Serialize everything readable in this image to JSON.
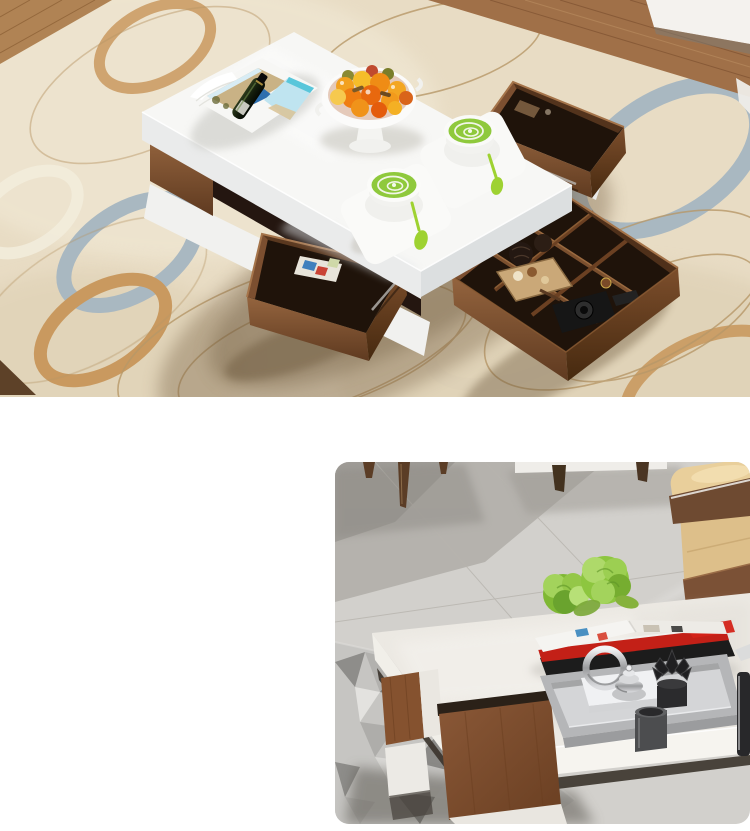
{
  "page": {
    "width": 750,
    "height": 831,
    "background": "#ffffff"
  },
  "photo_top": {
    "alt": "Overhead view of a white high-gloss coffee table with walnut pull-out drawers and an open storage organizer, styled with two matcha lattes, a white fruit bowl and an open magazine with a bottle, standing on a beige rug with blue and caramel ring pattern and wood flooring",
    "rect": {
      "x": 0,
      "y": 0,
      "width": 750,
      "height": 397
    },
    "palette": {
      "rug": "#e8dcc4",
      "ring_blue": "#a9b8c1",
      "ring_caramel": "#c9995f",
      "ring_gold_line": "#b79868",
      "wood_floor": "#a07048",
      "tv_cabinet_white": "#f4f2ee",
      "table_white": "#f7f7f5",
      "walnut": "#7c4f30",
      "drawer_interior": "#1f130a",
      "matcha": "#8fc93c",
      "spoon_green": "#9ed231",
      "fruit_orange": "#ef8c15",
      "magazine_sand": "#c9b285",
      "magazine_sky": "#bfe4f0",
      "car_blue": "#2e6fae",
      "bottle_green": "#1e2b14"
    },
    "objects": [
      "area-rug",
      "wood-floor",
      "tv-cabinet",
      "coffee-table",
      "tabletop",
      "open-magazine",
      "bottle",
      "fruit-bowl",
      "matcha-cup-front",
      "matcha-cup-back",
      "green-spoons",
      "open-drawer-upper",
      "open-drawer-lower",
      "storage-organizer",
      "camera",
      "wicker-balls",
      "snack-tray"
    ]
  },
  "photo_bottom": {
    "alt": "Close-up of a cream stone-look coffee table with walnut drawer fronts in a living room with grey marble floor, beige leather sofa, grey patchwork rug, magazines, green flowers and a silver decor tray with chrome and black ornaments",
    "rect": {
      "x": 335,
      "y": 462,
      "width": 415,
      "height": 362,
      "corner_radius": 14
    },
    "palette": {
      "marble_floor": "#d2d0cc",
      "floor_shadow": "#a8a5a0",
      "chair_leg": "#5b3d26",
      "sofa_beige": "#ddbf8a",
      "sofa_brown": "#6e4a31",
      "rug_grey": "#c6c5c2",
      "table_cream": "#ece9e3",
      "walnut": "#85522f",
      "tray_silver": "#b5b6b8",
      "tray_inner": "#d4d5d7",
      "accent_green": "#8dc63f",
      "book_red": "#c32017",
      "black_decor": "#28282a",
      "chrome": "#d9dadc"
    },
    "objects": [
      "marble-floor",
      "dining-chair-legs",
      "cabinet-base",
      "leather-sofa",
      "patchwork-rug",
      "coffee-table",
      "magazine-stack",
      "green-flowers",
      "decor-tray",
      "chrome-ring-ornament",
      "silver-pot",
      "black-lotus-ornament",
      "grey-cup",
      "black-vase"
    ]
  }
}
